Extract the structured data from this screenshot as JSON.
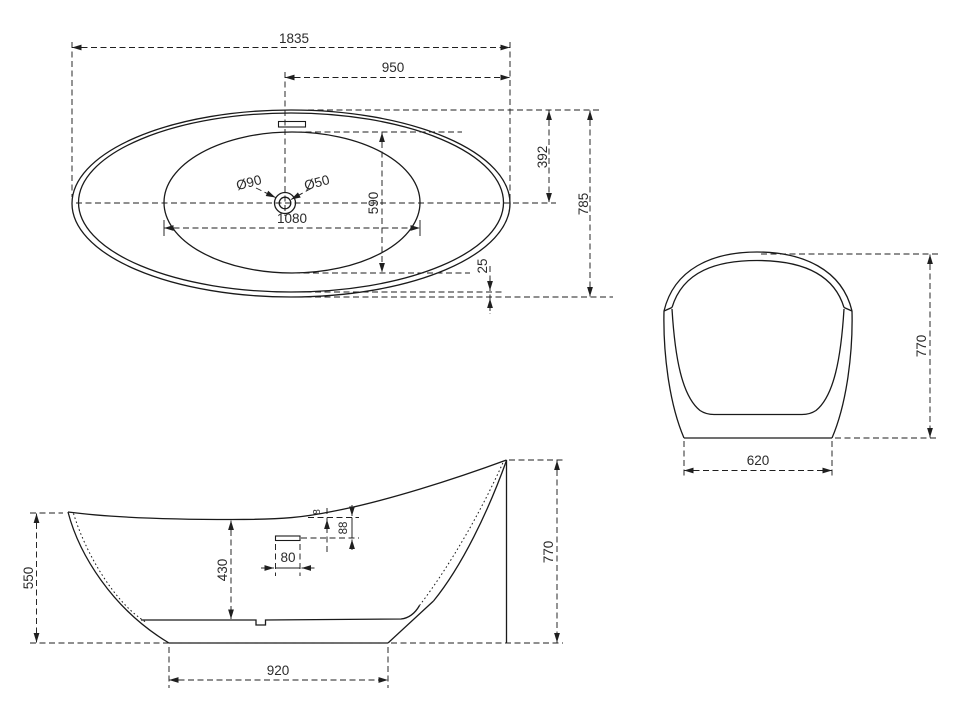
{
  "page": {
    "background": "#ffffff",
    "line_color": "#1a1a1a",
    "text_color": "#2b2b2b"
  },
  "views": {
    "top": {
      "dims": {
        "overall_length": "1835",
        "drain_to_back_end": "950",
        "rim_to_center": "392",
        "overall_width": "785",
        "basin_width": "590",
        "basin_length": "1080",
        "drain_outer_dia": "Ø90",
        "drain_hole_dia": "Ø50",
        "rim_edge_gap": "25"
      }
    },
    "side": {
      "dims": {
        "front_rim_height": "550",
        "inner_depth": "430",
        "overflow_slot_width": "80",
        "overflow_offset": "88",
        "rim_thickness": "8",
        "overall_height": "770",
        "base_length": "920"
      }
    },
    "end": {
      "dims": {
        "overall_height": "770",
        "base_width": "620"
      }
    }
  }
}
